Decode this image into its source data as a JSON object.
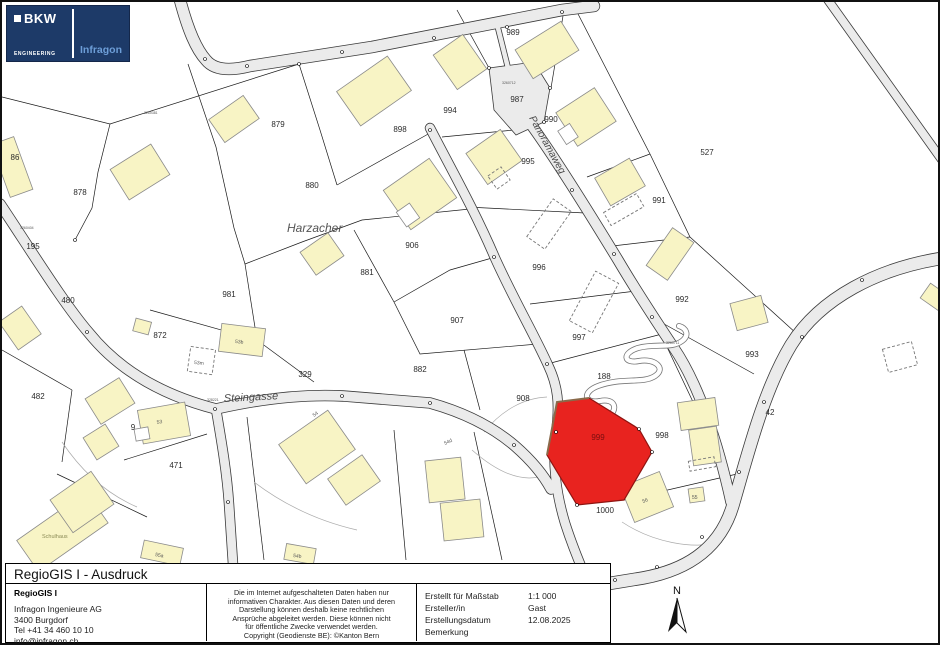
{
  "logo": {
    "brand": "BKW",
    "sub": "ENGINEERING",
    "product": "Infragon"
  },
  "compass": {
    "label": "N"
  },
  "map": {
    "highlight_parcel": {
      "label": "999",
      "fill": "#e8231f",
      "label_color": "#7a0f10"
    },
    "colors": {
      "building": "#f8f4c5",
      "road": "#ebebeb",
      "parcel_line": "#1a1a1a",
      "logo_navy": "#1d3a68",
      "infragon_blue": "#6d9ed8"
    },
    "parcel_labels": [
      {
        "t": "86",
        "x": 13,
        "y": 158
      },
      {
        "t": "878",
        "x": 78,
        "y": 193
      },
      {
        "t": "879",
        "x": 276,
        "y": 125
      },
      {
        "t": "898",
        "x": 398,
        "y": 130
      },
      {
        "t": "994",
        "x": 448,
        "y": 111
      },
      {
        "t": "989",
        "x": 511,
        "y": 33
      },
      {
        "t": "987",
        "x": 515,
        "y": 100
      },
      {
        "t": "990",
        "x": 549,
        "y": 120
      },
      {
        "t": "995",
        "x": 526,
        "y": 162
      },
      {
        "t": "991",
        "x": 657,
        "y": 201
      },
      {
        "t": "527",
        "x": 705,
        "y": 153
      },
      {
        "t": "880",
        "x": 310,
        "y": 186
      },
      {
        "t": "906",
        "x": 410,
        "y": 246
      },
      {
        "t": "881",
        "x": 365,
        "y": 273
      },
      {
        "t": "996",
        "x": 537,
        "y": 268
      },
      {
        "t": "992",
        "x": 680,
        "y": 300
      },
      {
        "t": "981",
        "x": 227,
        "y": 295
      },
      {
        "t": "872",
        "x": 158,
        "y": 336
      },
      {
        "t": "997",
        "x": 577,
        "y": 338
      },
      {
        "t": "993",
        "x": 750,
        "y": 355
      },
      {
        "t": "480",
        "x": 66,
        "y": 301
      },
      {
        "t": "482",
        "x": 36,
        "y": 397
      },
      {
        "t": "329",
        "x": 303,
        "y": 375
      },
      {
        "t": "907",
        "x": 455,
        "y": 321
      },
      {
        "t": "882",
        "x": 418,
        "y": 370
      },
      {
        "t": "188",
        "x": 602,
        "y": 377
      },
      {
        "t": "908",
        "x": 521,
        "y": 399
      },
      {
        "t": "998",
        "x": 660,
        "y": 436
      },
      {
        "t": "42",
        "x": 768,
        "y": 413
      },
      {
        "t": "9",
        "x": 131,
        "y": 428
      },
      {
        "t": "471",
        "x": 174,
        "y": 466
      },
      {
        "t": "1000",
        "x": 603,
        "y": 511
      },
      {
        "t": "195",
        "x": 31,
        "y": 247
      }
    ],
    "street_labels": [
      {
        "t": "Steingasse",
        "x": 222,
        "y": 400,
        "r": -3,
        "s": 11,
        "i": 1,
        "c": "#4a4a4a"
      },
      {
        "t": "Panoramaweg",
        "x": 527,
        "y": 116,
        "r": 61,
        "s": 10,
        "i": 1,
        "c": "#4a4a4a"
      },
      {
        "t": "Harzacher",
        "x": 285,
        "y": 230,
        "r": 0,
        "s": 12,
        "i": 1,
        "c": "#555555"
      }
    ],
    "building_labels": [
      {
        "t": "Schulhaus",
        "x": 40,
        "y": 536,
        "s": 5.5,
        "c": "#8a8a55"
      },
      {
        "t": "53",
        "x": 155,
        "y": 422,
        "s": 5,
        "r": -10,
        "c": "#555555"
      },
      {
        "t": "53b",
        "x": 233,
        "y": 341,
        "s": 5,
        "r": 5,
        "c": "#555555"
      },
      {
        "t": "53m",
        "x": 192,
        "y": 362,
        "s": 5,
        "r": 5,
        "c": "#555555"
      },
      {
        "t": "54",
        "x": 312,
        "y": 415,
        "s": 5,
        "r": -35,
        "c": "#555555"
      },
      {
        "t": "54d",
        "x": 443,
        "y": 443,
        "s": 5,
        "r": -25,
        "c": "#555555"
      },
      {
        "t": "54b",
        "x": 291,
        "y": 555,
        "s": 5,
        "r": 8,
        "c": "#555555"
      },
      {
        "t": "55a",
        "x": 153,
        "y": 554,
        "s": 5,
        "r": 10,
        "c": "#555555"
      },
      {
        "t": "55",
        "x": 690,
        "y": 497,
        "s": 5,
        "c": "#555555"
      },
      {
        "t": "56",
        "x": 641,
        "y": 501,
        "s": 5,
        "r": -20,
        "c": "#555555"
      }
    ],
    "survey_labels": [
      {
        "t": "3260712",
        "x": 500,
        "y": 82,
        "s": 3.5,
        "c": "#555555"
      },
      {
        "t": "328221",
        "x": 205,
        "y": 399,
        "s": 3.5,
        "c": "#555555"
      },
      {
        "t": "3260711",
        "x": 664,
        "y": 342,
        "s": 3.5,
        "c": "#555555"
      },
      {
        "t": "3260404",
        "x": 18,
        "y": 227,
        "s": 3.5,
        "c": "#555555"
      },
      {
        "t": "3260381",
        "x": 142,
        "y": 112,
        "s": 3.5,
        "c": "#555555"
      }
    ]
  },
  "footer": {
    "title": "RegioGIS I - Ausdruck",
    "org": {
      "name": "RegioGIS I",
      "lines": [
        "Infragon Ingenieure AG",
        "3400 Burgdorf",
        "Tel +41 34 460 10 10",
        "info@infragon.ch"
      ]
    },
    "disclaimer_lines": [
      "Die im Internet aufgeschalteten Daten haben nur",
      "informativen Charakter. Aus diesen Daten und deren",
      "Darstellung können deshalb keine rechtlichen",
      "Ansprüche abgeleitet werden. Diese können nicht",
      "für öffentliche Zwecke verwendet werden.",
      "Copyright (Geodienste BE): ©Kanton Bern"
    ],
    "meta": [
      {
        "label": "Erstellt für Maßstab",
        "value": "1:1 000"
      },
      {
        "label": "Ersteller/in",
        "value": "Gast"
      },
      {
        "label": "Erstellungsdatum",
        "value": "12.08.2025"
      },
      {
        "label": "Bemerkung",
        "value": ""
      }
    ]
  }
}
